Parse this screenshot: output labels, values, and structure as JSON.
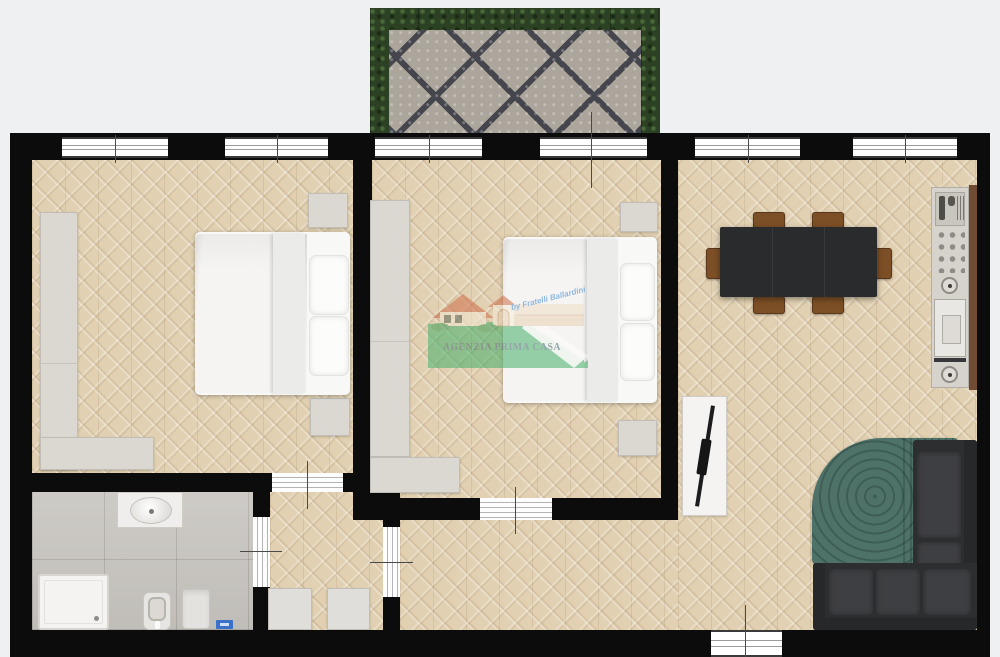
{
  "watermark": {
    "agency_name": "AGENZIA PRIMA CASA",
    "byline": "by Fratelli Ballardini"
  },
  "palette": {
    "background": "#eef0f2",
    "wall": "#0c0c0d",
    "parquet": "#e1d0b1",
    "bathroom_tile": "#c8c5c0",
    "terrace_stone": "#aba59b",
    "terrace_joint": "#45454d",
    "hedge_green": "#2c4123",
    "furniture_gray": "#dbd8d2",
    "table_charcoal": "#2a2b2d",
    "chair_wood": "#7c4f26",
    "sofa_charcoal": "#2d2e30",
    "rug_teal": "#4e7168",
    "logo_text": "#47666e",
    "logo_byline_blue": "#3b87d6",
    "logo_roof": "#cf6f4c",
    "logo_green": "#45b06b"
  },
  "floorplan": {
    "type": "apartment top-view plan",
    "rooms": [
      {
        "name": "terrace",
        "features": [
          "hedge border",
          "mosaic stone paving"
        ]
      },
      {
        "name": "bedroom-1",
        "features": [
          "double bed",
          "L-shaped wardrobe",
          "2 nightstands",
          "2 windows"
        ]
      },
      {
        "name": "bedroom-2",
        "features": [
          "double bed",
          "L-shaped wardrobe",
          "2 nightstands",
          "2 windows"
        ]
      },
      {
        "name": "living-dining",
        "features": [
          "dining table with 6 chairs",
          "kitchenette counter",
          "corner sofa",
          "teal rug",
          "radiator panel",
          "3 windows"
        ]
      },
      {
        "name": "bathroom",
        "features": [
          "shower tray",
          "vanity sink",
          "toilet",
          "bidet",
          "scale"
        ]
      },
      {
        "name": "hallway",
        "features": [
          "2 cabinets",
          "4 doors"
        ]
      }
    ]
  }
}
